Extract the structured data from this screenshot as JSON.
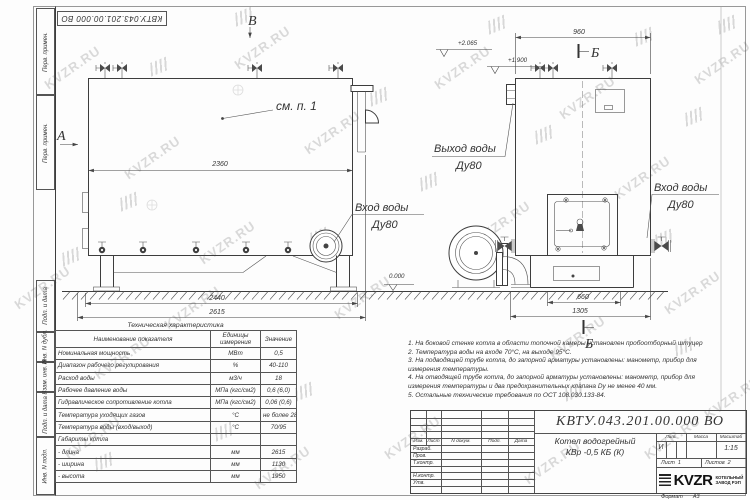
{
  "doc_number": "КВТУ.043.201.00.000 ВО",
  "margin_column": {
    "blocks": [
      "Перв. примен.",
      "Перв. примен.",
      "Подп. и дата",
      "Инв. N дубл.",
      "Взам. инв. N",
      "Подп. и дата",
      "Инв. N подл."
    ]
  },
  "drawing": {
    "section_markers": {
      "a": "А",
      "v": "В",
      "b_top": "Б",
      "b_bottom": "Б"
    },
    "callouts": {
      "see_item": "см. п. 1",
      "outlet_line1": "Выход воды",
      "outlet_line2": "Ду80",
      "inlet_left_line1": "Вход воды",
      "inlet_left_line2": "Ду80",
      "inlet_right_line1": "Вход воды",
      "inlet_right_line2": "Ду80"
    },
    "dimensions": {
      "upper_length": "2360",
      "frame_length": "2440",
      "overall_length": "2615",
      "front_width": "960",
      "base_width": "660",
      "overall_width": "1305"
    },
    "elevations": {
      "top": "+2.065",
      "upper": "+1.900",
      "zero": "0.000"
    }
  },
  "tech_table": {
    "title": "Техническая характеристика",
    "headers": [
      "Наименование показателя",
      "Единицы измерения",
      "Значение"
    ],
    "rows": [
      [
        "Номинальная мощность",
        "МВт",
        "0,5"
      ],
      [
        "Диапазон рабочего регулирования",
        "%",
        "40-110"
      ],
      [
        "Расход воды",
        "м3/ч",
        "18"
      ],
      [
        "Рабочее давление воды",
        "МПа (кгс/см2)",
        "0,6 (6,0)"
      ],
      [
        "Гидравлическое сопротивление котла",
        "МПа (кгс/см2)",
        "0,06 (0,6)"
      ],
      [
        "Температура уходящих газов",
        "°С",
        "не более 280"
      ],
      [
        "Температура воды (вход/выход)",
        "°С",
        "70/95"
      ],
      [
        "Габариты котла",
        "",
        ""
      ],
      [
        "- длина",
        "мм",
        "2615"
      ],
      [
        "- ширина",
        "мм",
        "1130"
      ],
      [
        "- высота",
        "мм",
        "1950"
      ]
    ]
  },
  "notes": {
    "lines": [
      "1.  На боковой стенке котла в области топочной камеры установлен пробоотборный штуцер",
      "2.  Температура воды на входе  70°С,  на выходе  95°С.",
      "3.  На подводящей трубе котла,  до запорной арматуры установлены:  манометр,  прибор для",
      "измерения температуры.",
      "4.  На отводящей трубе котла, до запорной арматуры установлены:  манометр,  прибор для",
      "измерения температуры и два предохранительных клапана  Dу не менее  40 мм.",
      "5.  Остальные технические требования по ОСТ  108.030.133-84."
    ]
  },
  "title_block": {
    "doc_number": "КВТУ.043.201.00.000 ВО",
    "product_name_line1": "Котел водогрейный",
    "product_name_line2": "КВр -0,5  КБ  (К)",
    "header_cols": [
      "Изм.",
      "Лист",
      "N докум.",
      "Подп.",
      "Дата"
    ],
    "roles": [
      "Разраб.",
      "Пров.",
      "Т.контр.",
      "Н.контр.",
      "Утв."
    ],
    "lit_label": "Лит.",
    "lit_value": "И",
    "mass_label": "Масса",
    "scale_label": "Масштаб",
    "scale_value": "1:15",
    "sheet_label": "Лист",
    "sheet_value": "1",
    "sheets_label": "Листов",
    "sheets_value": "2",
    "company_name": "KVZR",
    "company_sub1": "КОТЕЛЬНЫЙ",
    "company_sub2": "ЗАВОД РЭП",
    "format_label": "Формат",
    "format_value": "А3"
  },
  "watermark": {
    "text": "KVZR.RU"
  }
}
